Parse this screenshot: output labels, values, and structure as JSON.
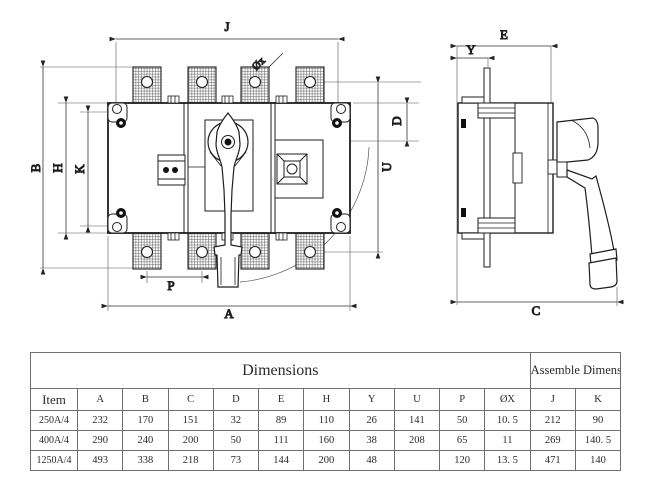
{
  "drawing": {
    "labels": {
      "j": "J",
      "b": "B",
      "h": "H",
      "k": "K",
      "d": "D",
      "u": "U",
      "p": "P",
      "a": "A",
      "phix": "Øx",
      "e": "E",
      "y": "Y",
      "c": "C"
    }
  },
  "table": {
    "banner": {
      "dimensions": "Dimensions",
      "assemble": "Assemble Dimension"
    },
    "columns": [
      "Item",
      "A",
      "B",
      "C",
      "D",
      "E",
      "H",
      "Y",
      "U",
      "P",
      "ØX",
      "J",
      "K"
    ],
    "rows": [
      {
        "item": "250A/4",
        "values": [
          "232",
          "170",
          "151",
          "32",
          "89",
          "110",
          "26",
          "141",
          "50",
          "10. 5",
          "212",
          "90"
        ]
      },
      {
        "item": "400A/4",
        "values": [
          "290",
          "240",
          "200",
          "50",
          "111",
          "160",
          "38",
          "208",
          "65",
          "11",
          "269",
          "140. 5"
        ]
      },
      {
        "item": "1250A/4",
        "values": [
          "493",
          "338",
          "218",
          "73",
          "144",
          "200",
          "48",
          "",
          "120",
          "13. 5",
          "471",
          "140"
        ]
      }
    ]
  },
  "colors": {
    "line": "#1e1e1e",
    "dim_line": "#3a3a3a",
    "table_border": "#6f6f6f",
    "background": "#ffffff"
  }
}
